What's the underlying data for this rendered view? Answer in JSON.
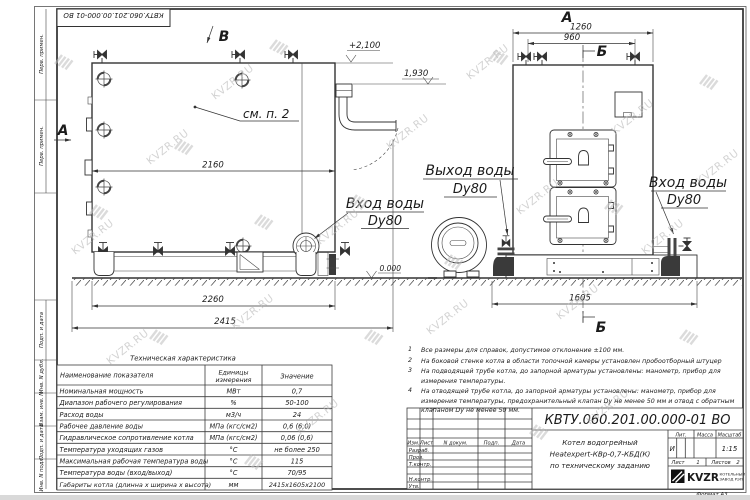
{
  "watermark": "KVZR.RU",
  "side_strip": {
    "labels": [
      "Перв. примен.",
      "Перв. примен.",
      "Подп. и дата",
      "Инв. N дубл.",
      "Взам. инв. N",
      "Подп. и дата",
      "Инв. N подл."
    ]
  },
  "views": {
    "side": {
      "arrow_b": "В",
      "arrow_a": "А",
      "see_note": "см. п. 2",
      "dim_body": "2160",
      "dim_base": "2260",
      "dim_overall": "2415",
      "level_top": "+2,100",
      "level_mid": "1,930",
      "level_zero": "0.000",
      "inlet_line1": "Вход воды",
      "inlet_line2": "Dy80"
    },
    "front": {
      "label_a": "А",
      "label_b_top": "Б",
      "label_b_bottom": "Б",
      "dim_overall": "1260",
      "dim_valves": "960",
      "dim_depth": "1605",
      "outlet_line1": "Выход воды",
      "outlet_line2": "Dy80",
      "inlet_line1": "Вход воды",
      "inlet_line2": "Dy80"
    }
  },
  "spec_table": {
    "title": "Техническая характеристика",
    "headers": {
      "name": "Наименование показателя",
      "unit_line1": "Единицы",
      "unit_line2": "измерения",
      "value": "Значение"
    },
    "rows": [
      {
        "name": "Номинальная мощность",
        "unit": "МВт",
        "value": "0,7"
      },
      {
        "name": "Диапазон рабочего регулирования",
        "unit": "%",
        "value": "50-100"
      },
      {
        "name": "Расход воды",
        "unit": "м3/ч",
        "value": "24"
      },
      {
        "name": "Рабочее давление воды",
        "unit": "МПа (кгс/см2)",
        "value": "0,6 (6,0)"
      },
      {
        "name": "Гидравлическое сопротивление котла",
        "unit": "МПа (кгс/см2)",
        "value": "0,06 (0,6)"
      },
      {
        "name": "Температура уходящих газов",
        "unit": "°С",
        "value": "не более 250"
      },
      {
        "name": "Максимальная рабочая температура воды",
        "unit": "°С",
        "value": "115"
      },
      {
        "name": "Температура воды (вход/выход)",
        "unit": "°С",
        "value": "70/95"
      },
      {
        "name": "Габариты котла (длинна х ширина х высота)",
        "unit": "мм",
        "value": "2415х1605х2100"
      }
    ]
  },
  "notes": [
    {
      "num": "1",
      "text": "Все размеры для справок, допустимое отклонение ±100 мм."
    },
    {
      "num": "2",
      "text": "На боковой стенке котла в области топочной камеры установлен пробоотборный штуцер"
    },
    {
      "num": "3",
      "text": "На подводящей трубе котла, до запорной арматуры установлены: манометр, прибор для измерения температуры."
    },
    {
      "num": "4",
      "text": "На отводящей трубе котла, до запорной арматуры установлены: манометр, прибор для измерения температуры, предохранительный клапан Dу не менее 50 мм и отвод с обратным клапаном Dу не менее 50 мм."
    }
  ],
  "title_block": {
    "doc_number": "КВТУ.060.201.00.000-01 ВО",
    "product_line1": "Котел водогрейный",
    "product_line2": "Heatexpert-КВр-0,7-КБД(К)",
    "product_line3": "по техническому заданию",
    "col_headers": [
      "Изм.",
      "Лист",
      "N докум.",
      "Подп.",
      "Дата"
    ],
    "row_labels": [
      "Разраб.",
      "Пров.",
      "Т.контр.",
      "Н.контр.",
      "Утв."
    ],
    "lit_header": "Лит.",
    "mass_header": "Масса",
    "scale_header": "Масштаб",
    "lit_value": "И",
    "scale_value": "1:15",
    "sheet_label": "Лист",
    "sheet_value": "1",
    "sheets_label": "Листов",
    "sheets_value": "2",
    "logo_text": "KVZR",
    "company_line1": "КОТЕЛЬНЫЙ",
    "company_line2": "ЗАВОД РЭП",
    "format_label": "Формат А3"
  }
}
